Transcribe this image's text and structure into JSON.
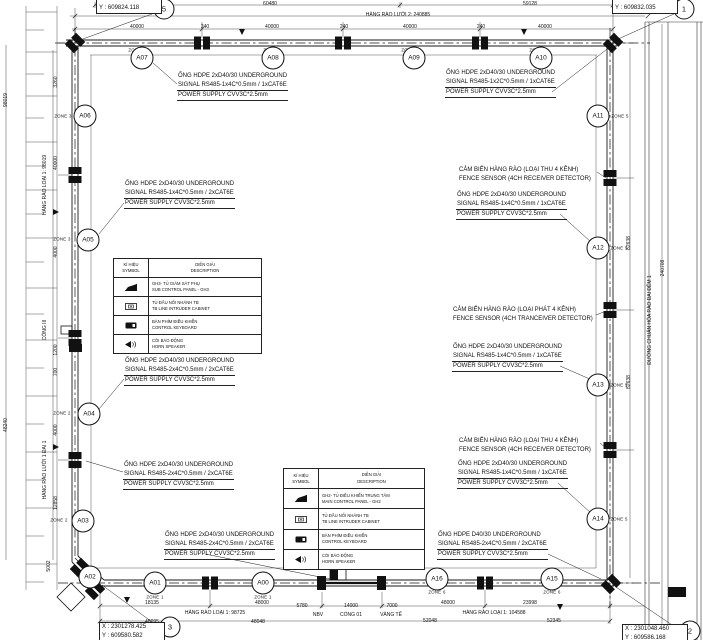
{
  "drawing": {
    "grid_bubbles": [
      {
        "label": "5",
        "x": 164,
        "y": 9
      },
      {
        "label": "1",
        "x": 684,
        "y": 9
      },
      {
        "label": "3",
        "x": 170,
        "y": 627
      },
      {
        "label": "2",
        "x": 690,
        "y": 631
      }
    ],
    "callouts": [
      {
        "line1": "X : 2301230.438",
        "line2": "Y : 609824.118",
        "x": 96,
        "y": -6
      },
      {
        "line1": "X : 2301040.585",
        "line2": "Y : 609832.035",
        "x": 612,
        "y": -6
      },
      {
        "line1": "X : 2301278.425",
        "line2": "Y : 609580.582",
        "x": 99,
        "y": 622
      },
      {
        "line1": "X : 2301048.460",
        "line2": "Y : 609586.168",
        "x": 622,
        "y": 624
      }
    ],
    "nodes": [
      {
        "label": "A07",
        "x": 142,
        "y": 58
      },
      {
        "label": "A08",
        "x": 273,
        "y": 58
      },
      {
        "label": "A09",
        "x": 414,
        "y": 58
      },
      {
        "label": "A10",
        "x": 541,
        "y": 58
      },
      {
        "label": "A06",
        "x": 85,
        "y": 116
      },
      {
        "label": "A11",
        "x": 598,
        "y": 116
      },
      {
        "label": "A05",
        "x": 88,
        "y": 240
      },
      {
        "label": "A12",
        "x": 598,
        "y": 248
      },
      {
        "label": "A13",
        "x": 598,
        "y": 385
      },
      {
        "label": "A04",
        "x": 89,
        "y": 414
      },
      {
        "label": "A03",
        "x": 83,
        "y": 521
      },
      {
        "label": "A14",
        "x": 598,
        "y": 519
      },
      {
        "label": "A02",
        "x": 90,
        "y": 577
      },
      {
        "label": "A01",
        "x": 155,
        "y": 583
      },
      {
        "label": "A00",
        "x": 263,
        "y": 583
      },
      {
        "label": "A16",
        "x": 437,
        "y": 579
      },
      {
        "label": "A15",
        "x": 552,
        "y": 579
      }
    ],
    "zones": [
      {
        "t": "ZONE 4",
        "x": 137,
        "y": 50
      },
      {
        "t": "ZONE 4",
        "x": 272,
        "y": 50
      },
      {
        "t": "ZONE 4",
        "x": 410,
        "y": 50
      },
      {
        "t": "ZONE 4",
        "x": 538,
        "y": 50
      },
      {
        "t": "ZONE 3",
        "x": 63,
        "y": 116
      },
      {
        "t": "ZONE 3",
        "x": 62,
        "y": 239
      },
      {
        "t": "ZONE 2",
        "x": 62,
        "y": 413
      },
      {
        "t": "ZONE 2",
        "x": 59,
        "y": 520
      },
      {
        "t": "ZONE 1",
        "x": 155,
        "y": 597
      },
      {
        "t": "ZONE 1",
        "x": 263,
        "y": 597
      },
      {
        "t": "ZONE 6",
        "x": 437,
        "y": 592
      },
      {
        "t": "ZONE 6",
        "x": 552,
        "y": 592
      },
      {
        "t": "ZONE 5",
        "x": 620,
        "y": 116
      },
      {
        "t": "ZONE 5",
        "x": 619,
        "y": 248
      },
      {
        "t": "ZONE 5",
        "x": 619,
        "y": 385
      },
      {
        "t": "ZONE 5",
        "x": 619,
        "y": 519
      }
    ],
    "annotations": [
      {
        "cls": "hdpe",
        "x": 177,
        "y": 72,
        "lines": [
          "ỐNG HDPE 2xD40/30 UNDERGROUND",
          "SIGNAL RS485-1x4C*0.5mm / 1xCAT6E",
          "POWER SUPPLY CVV3C*2.5mm"
        ]
      },
      {
        "cls": "hdpe",
        "x": 445,
        "y": 69,
        "lines": [
          "ỐNG HDPE 2xD40/30 UNDERGROUND",
          "SIGNAL RS485-1x2C*0.5mm / 1xCAT6E",
          "POWER SUPPLY CVV3C*2.5mm"
        ]
      },
      {
        "cls": "hdpe",
        "x": 124,
        "y": 180,
        "lines": [
          "ỐNG HDPE 2xD40/30 UNDERGROUND",
          "SIGNAL RS485-1x4C*0.5mm / 2xCAT6E",
          "POWER SUPPLY CVV3C*2.5mm"
        ]
      },
      {
        "cls": "sensor",
        "x": 458,
        "y": 166,
        "lines": [
          "CẢM BIẾN HÀNG RÀO (LOẠI THU 4 KÊNH)",
          "FENCE SENSOR (4CH RECEIVER DETECTOR)"
        ]
      },
      {
        "cls": "hdpe",
        "x": 456,
        "y": 191,
        "lines": [
          "ỐNG HDPE 2xD40/30 UNDERGROUND",
          "SIGNAL RS485-1x4C*0.5mm / 1xCAT6E",
          "POWER SUPPLY CVV3C*2.5mm"
        ]
      },
      {
        "cls": "sensor",
        "x": 452,
        "y": 306,
        "lines": [
          "CẢM BIẾN HÀNG RÀO (LOẠI PHÁT 4 KÊNH)",
          "FENCE SENSOR (4CH TRANCEIVER DETECTOR)"
        ]
      },
      {
        "cls": "hdpe",
        "x": 452,
        "y": 343,
        "lines": [
          "ỐNG HDPE 2xD40/30 UNDERGROUND",
          "SIGNAL RS485-1x4C*0.5mm / 1xCAT6E",
          "POWER SUPPLY CVV3C*2.5mm"
        ]
      },
      {
        "cls": "hdpe",
        "x": 124,
        "y": 357,
        "lines": [
          "ỐNG HDPE 2xD40/30 UNDERGROUND",
          "SIGNAL RS485-2x4C*0.5mm / 2xCAT6E",
          "POWER SUPPLY CVV3C*2.5mm"
        ]
      },
      {
        "cls": "sensor",
        "x": 458,
        "y": 437,
        "lines": [
          "CẢM BIẾN HÀNG RÀO (LOẠI THU 4 KÊNH)",
          "FENCE SENSOR (4CH RECEIVER DETECTOR)"
        ]
      },
      {
        "cls": "hdpe",
        "x": 457,
        "y": 460,
        "lines": [
          "ỐNG HDPE 2xD40/30 UNDERGROUND",
          "SIGNAL RS485-1x4C*0.5mm / 1xCAT6E",
          "POWER SUPPLY CVV3C*2.5mm"
        ]
      },
      {
        "cls": "hdpe",
        "x": 123,
        "y": 461,
        "lines": [
          "ỐNG HDPE 2xD40/30 UNDERGROUND",
          "SIGNAL RS485-2x4C*0.5mm / 2xCAT6E",
          "POWER SUPPLY CVV3C*2.5mm"
        ]
      },
      {
        "cls": "hdpe",
        "x": 164,
        "y": 531,
        "lines": [
          "ỐNG HDPE 2xD40/30 UNDERGROUND",
          "SIGNAL RS485-2x4C*0.5mm / 2xCAT6E",
          "POWER SUPPLY CVV3C*2.5mm"
        ]
      },
      {
        "cls": "hdpe",
        "x": 437,
        "y": 531,
        "lines": [
          "ỐNG HDPE D40/30 UNDERGROUND",
          "SIGNAL RS485-2x4C*0.5mm / 2xCAT6E",
          "POWER SUPPLY CVV3C*2.5mm"
        ]
      }
    ],
    "dimensions": [
      {
        "t": "60480",
        "x": 270,
        "y": 4
      },
      {
        "t": "59128",
        "x": 530,
        "y": 4
      },
      {
        "t": "HÀNG RÀO LƯỚI 2: 240885",
        "x": 398,
        "y": 15
      },
      {
        "t": "40000",
        "x": 137,
        "y": 27
      },
      {
        "t": "240",
        "x": 205,
        "y": 27
      },
      {
        "t": "40000",
        "x": 272,
        "y": 27
      },
      {
        "t": "240",
        "x": 344,
        "y": 27
      },
      {
        "t": "40000",
        "x": 410,
        "y": 27
      },
      {
        "t": "240",
        "x": 481,
        "y": 27
      },
      {
        "t": "40000",
        "x": 545,
        "y": 27
      },
      {
        "t": "18135",
        "x": 152,
        "y": 603
      },
      {
        "t": "48000",
        "x": 262,
        "y": 603
      },
      {
        "t": "5780",
        "x": 302,
        "y": 606
      },
      {
        "t": "14000",
        "x": 351,
        "y": 606
      },
      {
        "t": "7000",
        "x": 392,
        "y": 606
      },
      {
        "t": "48000",
        "x": 448,
        "y": 603
      },
      {
        "t": "23998",
        "x": 530,
        "y": 603
      },
      {
        "t": "NBV",
        "x": 318,
        "y": 615
      },
      {
        "t": "CỔNG 01",
        "x": 351,
        "y": 615
      },
      {
        "t": "VÀNG TẾ",
        "x": 391,
        "y": 615
      },
      {
        "t": "HÀNG RÀO LOẠI 1: 98725",
        "x": 215,
        "y": 613
      },
      {
        "t": "HÀNG RÀO LOẠI 1: 104588",
        "x": 494,
        "y": 613
      },
      {
        "t": "48095",
        "x": 152,
        "y": 622
      },
      {
        "t": "48048",
        "x": 258,
        "y": 622
      },
      {
        "t": "52048",
        "x": 430,
        "y": 621
      },
      {
        "t": "52345",
        "x": 554,
        "y": 621
      },
      {
        "t": "98019",
        "x": 6,
        "y": 100,
        "cls": "rot"
      },
      {
        "t": "48240",
        "x": 6,
        "y": 425,
        "cls": "rot"
      },
      {
        "t": "3260",
        "x": 56,
        "y": 82,
        "cls": "rot"
      },
      {
        "t": "40000",
        "x": 56,
        "y": 163,
        "cls": "rot"
      },
      {
        "t": "4000",
        "x": 56,
        "y": 252,
        "cls": "rot"
      },
      {
        "t": "1200",
        "x": 56,
        "y": 350,
        "cls": "rot"
      },
      {
        "t": "700",
        "x": 56,
        "y": 372,
        "cls": "rot"
      },
      {
        "t": "4000",
        "x": 56,
        "y": 430,
        "cls": "rot"
      },
      {
        "t": "12858",
        "x": 56,
        "y": 503,
        "cls": "rot"
      },
      {
        "t": "5002",
        "x": 49,
        "y": 566,
        "cls": "rot"
      },
      {
        "t": "HÀNG RÀO LOẠI 1: 98019",
        "x": 45,
        "y": 185,
        "cls": "rot"
      },
      {
        "t": "CỔNG III",
        "x": 45,
        "y": 330,
        "cls": "rot"
      },
      {
        "t": "HÀNG RÀO LƯỚI 1 ĐAI 1",
        "x": 45,
        "y": 470,
        "cls": "rot"
      },
      {
        "t": "240708",
        "x": 663,
        "y": 268,
        "cls": "rot"
      },
      {
        "t": "82638",
        "x": 629,
        "y": 243,
        "cls": "rot"
      },
      {
        "t": "82638",
        "x": 629,
        "y": 382,
        "cls": "rot"
      },
      {
        "t": "ĐƯỜNG CHUẨN HÓA RÀO ĐAI ĐÊM 1",
        "x": 650,
        "y": 320,
        "cls": "rot"
      }
    ],
    "legends": [
      {
        "header": {
          "symbol": [
            "KÍ HIỆU",
            "SYMBOL"
          ],
          "description": [
            "DIỄN GIẢI",
            "DESCRIPTION"
          ]
        },
        "rows": [
          {
            "line1": "GH3- TỦ GIÁM SÁT PHỤ",
            "line2": "SUB CONTROL PANEL - GH3"
          },
          {
            "line1": "TỦ ĐẤU NỐI NHÁNH TB",
            "line2": "TB LINE INTRUDER CABINET"
          },
          {
            "line1": "BÀN PHÍM ĐIỀU KHIỂN",
            "line2": "CONTROL KEYBOARD"
          },
          {
            "line1": "CÒI BÁO ĐỘNG",
            "line2": "HORN SPEAKER"
          }
        ]
      },
      {
        "header": {
          "symbol": [
            "KÍ HIỆU",
            "SYMBOL"
          ],
          "description": [
            "DIỄN GIẢI",
            "DESCRIPTION"
          ]
        },
        "rows": [
          {
            "line1": "GH2- TỦ ĐIỀU KHIỂN TRUNG TÂM",
            "line2": "MAIN CONTROL PANEL - GH2"
          },
          {
            "line1": "TỦ ĐẤU NỐI NHÁNH TB",
            "line2": "TB LINE INTRUDER CABINET"
          },
          {
            "line1": "BÀN PHÍM ĐIỀU KHIỂN",
            "line2": "CONTROL KEYBOARD"
          },
          {
            "line1": "CÒI BÁO ĐỘNG",
            "line2": "HORN SPEAKER"
          }
        ]
      }
    ]
  }
}
